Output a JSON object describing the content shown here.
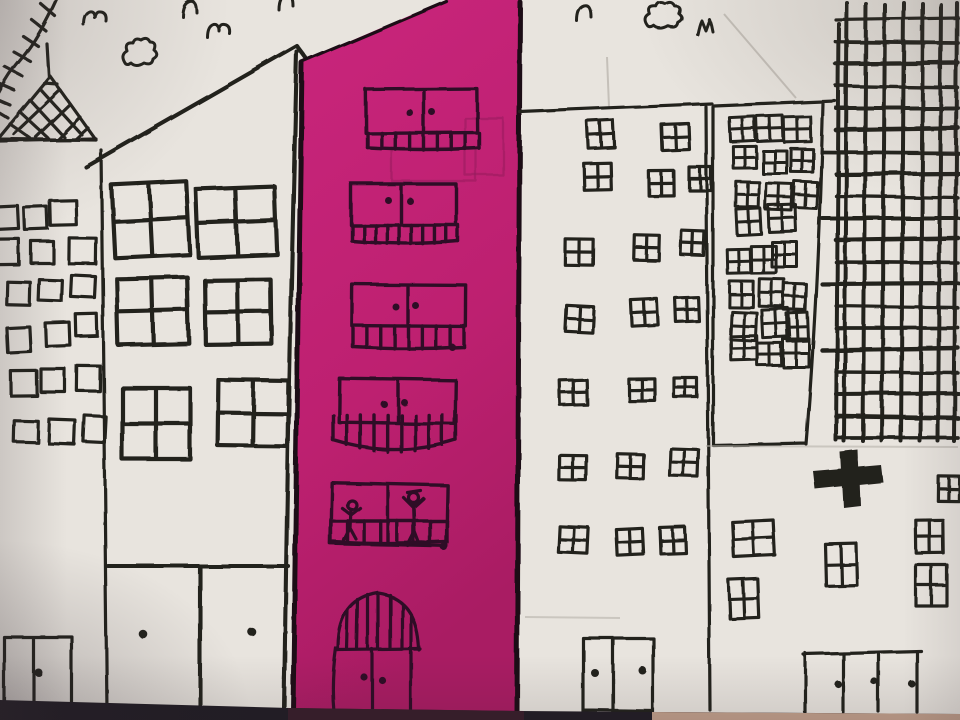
{
  "scene": {
    "description": "Child's felt-tip marker drawing of a city street on cream paper: a tower with a lattice spire, a peaked-roof house, a tall magenta tower with balconies and two stick figures, two white towers full of four-pane windows, a dense grid skyscraper, birds and scribbled clouds in the sky; the paper sits on a dark table edge.",
    "medium": "black marker on paper, magenta painted tower, photographed",
    "colors": {
      "paper": "#e8e4de",
      "ink": "#24201f",
      "ink_plum": "#2e1026",
      "magenta": "#c42478",
      "magenta_deep": "#a81c62",
      "pencil": "#b3aea6",
      "table_dark": "#211d25",
      "table_plum": "#3c1f2d",
      "table_tan": "#c2a08c"
    }
  },
  "sky": {
    "birds": [
      {
        "type": "m",
        "x": 84,
        "y": 10
      },
      {
        "type": "n",
        "x": 182,
        "y": 0
      },
      {
        "type": "m",
        "x": 207,
        "y": 22
      },
      {
        "type": "n",
        "x": 279,
        "y": -6
      },
      {
        "type": "n",
        "x": 577,
        "y": 5
      },
      {
        "type": "M",
        "x": 697,
        "y": 19
      }
    ],
    "clouds": [
      {
        "x": 121,
        "y": 37,
        "w": 37,
        "h": 33
      },
      {
        "x": 644,
        "y": 1,
        "w": 39,
        "h": 32
      }
    ],
    "creases": [
      [
        607,
        57,
        609,
        107
      ],
      [
        724,
        14,
        796,
        98
      ]
    ]
  },
  "buildings": {
    "left_tower": {
      "label": "tower with lattice spire",
      "window_type": "square",
      "windows": [
        [
          -6,
          206,
          24,
          23
        ],
        [
          24,
          207,
          23,
          22
        ],
        [
          50,
          200,
          26,
          25
        ],
        [
          -5,
          239,
          24,
          26
        ],
        [
          31,
          241,
          22,
          22
        ],
        [
          69,
          238,
          27,
          26
        ],
        [
          7,
          282,
          23,
          23
        ],
        [
          39,
          280,
          23,
          21
        ],
        [
          71,
          276,
          24,
          21
        ],
        [
          7,
          327,
          23,
          25
        ],
        [
          46,
          323,
          24,
          23
        ],
        [
          76,
          314,
          21,
          22
        ],
        [
          11,
          371,
          26,
          25
        ],
        [
          41,
          369,
          24,
          23
        ],
        [
          77,
          366,
          23,
          25
        ],
        [
          14,
          421,
          24,
          21
        ],
        [
          49,
          420,
          26,
          24
        ],
        [
          84,
          416,
          21,
          26
        ]
      ],
      "door": {
        "x": 4,
        "y": 637,
        "w": 68,
        "h": 70,
        "divider_x": 33,
        "dots": [
          [
            38,
            672
          ]
        ]
      }
    },
    "gable_house": {
      "label": "house with peaked roof",
      "window_type": "four-pane-large",
      "windows": [
        [
          113,
          183,
          75,
          73
        ],
        [
          197,
          188,
          79,
          68
        ],
        [
          117,
          278,
          71,
          66
        ],
        [
          205,
          280,
          66,
          64
        ],
        [
          122,
          388,
          68,
          71
        ],
        [
          218,
          380,
          70,
          66
        ]
      ],
      "doors": {
        "sill_y": 566,
        "x1": 108,
        "x2": 288,
        "divider_x": 200,
        "dots": [
          [
            143,
            634
          ],
          [
            252,
            632
          ]
        ]
      }
    },
    "magenta_tower": {
      "label": "magenta balcony tower",
      "figures_on_balcony": 2,
      "pencil_ghosts": [
        [
          392,
          148,
          84,
          33
        ],
        [
          465,
          118,
          38,
          57
        ]
      ],
      "floors": [
        {
          "win": [
            366,
            89,
            111,
            44
          ],
          "div": 424,
          "dots": [
            [
              410,
              113
            ],
            [
              432,
              112
            ]
          ],
          "rail": {
            "x1": 368,
            "x2": 479,
            "ytop": 133,
            "ybot": 150,
            "bars": 8,
            "curve": 2
          }
        },
        {
          "win": [
            351,
            184,
            105,
            41
          ],
          "div": 401,
          "dots": [
            [
              388,
              200
            ],
            [
              410,
              201
            ]
          ],
          "rail": {
            "x1": 352,
            "x2": 458,
            "ytop": 225,
            "ybot": 244,
            "bars": 9,
            "curve": 3
          }
        },
        {
          "win": [
            352,
            285,
            114,
            41
          ],
          "div": 408,
          "dots": [
            [
              396,
              307
            ],
            [
              416,
              306
            ],
            [
              452,
              347
            ]
          ],
          "rail": {
            "x1": 353,
            "x2": 464,
            "ytop": 326,
            "ybot": 349,
            "bars": 8,
            "curve": 2
          }
        },
        {
          "win": [
            339,
            379,
            116,
            44
          ],
          "div": 398,
          "dots": [
            [
              384,
              404
            ],
            [
              404,
              402
            ]
          ],
          "rail": {
            "x1": 333,
            "x2": 456,
            "ytop": 415,
            "ybot": 452,
            "bars": 9,
            "curve": 12
          }
        },
        {
          "win": [
            331,
            484,
            116,
            61
          ],
          "div": 388,
          "dots": [
            [
              444,
              547
            ]
          ],
          "midrail": 521,
          "rail": {
            "x1": 331,
            "x2": 447,
            "ytop": 521,
            "ybot": 544,
            "bars": 7,
            "curve": 2
          }
        }
      ],
      "door": {
        "dots": [
          [
            364,
            677
          ],
          [
            382,
            680
          ]
        ]
      }
    },
    "mid_tower": {
      "label": "white tower with scattered windows",
      "window_type": "four-pane-small",
      "windows": [
        [
          588,
          121,
          26,
          27
        ],
        [
          662,
          124,
          27,
          26
        ],
        [
          584,
          163,
          27,
          27
        ],
        [
          649,
          171,
          25,
          25
        ],
        [
          689,
          167,
          22,
          23
        ],
        [
          565,
          239,
          28,
          26
        ],
        [
          634,
          235,
          25,
          25
        ],
        [
          681,
          231,
          23,
          24
        ],
        [
          566,
          306,
          27,
          26
        ],
        [
          631,
          299,
          26,
          26
        ],
        [
          676,
          298,
          23,
          24
        ],
        [
          560,
          380,
          27,
          25
        ],
        [
          629,
          379,
          26,
          22
        ],
        [
          674,
          378,
          23,
          19
        ],
        [
          559,
          455,
          27,
          25
        ],
        [
          617,
          454,
          26,
          24
        ],
        [
          670,
          449,
          28,
          27
        ],
        [
          559,
          527,
          29,
          26
        ],
        [
          617,
          529,
          26,
          26
        ],
        [
          660,
          527,
          25,
          26
        ]
      ],
      "door": {
        "x": 583,
        "y": 638,
        "w": 70,
        "h": 74,
        "divider_x": 613,
        "dots": [
          [
            595,
            673
          ],
          [
            642,
            670
          ]
        ]
      },
      "pencil_lines": [
        [
          525,
          617,
          620,
          618
        ]
      ]
    },
    "dense_tower": {
      "label": "narrow tower packed with windows",
      "window_type": "four-pane-small",
      "windows": [
        [
          730,
          117,
          25,
          24
        ],
        [
          757,
          116,
          26,
          25
        ],
        [
          784,
          117,
          27,
          25
        ],
        [
          733,
          146,
          23,
          22
        ],
        [
          763,
          151,
          24,
          23
        ],
        [
          791,
          149,
          22,
          23
        ],
        [
          736,
          182,
          23,
          25
        ],
        [
          766,
          184,
          26,
          26
        ],
        [
          794,
          182,
          23,
          26
        ],
        [
          737,
          209,
          24,
          26
        ],
        [
          769,
          205,
          27,
          27
        ],
        [
          727,
          249,
          23,
          24
        ],
        [
          751,
          246,
          25,
          27
        ],
        [
          772,
          242,
          25,
          25
        ],
        [
          729,
          281,
          24,
          26
        ],
        [
          759,
          279,
          25,
          27
        ],
        [
          784,
          284,
          22,
          26
        ],
        [
          731,
          312,
          25,
          28
        ],
        [
          762,
          309,
          27,
          28
        ],
        [
          787,
          313,
          21,
          28
        ],
        [
          731,
          336,
          26,
          24
        ],
        [
          757,
          343,
          24,
          22
        ],
        [
          783,
          339,
          26,
          28
        ]
      ]
    },
    "grid_tower": {
      "label": "skyscraper drawn as dense grid",
      "cols": [
        847,
        866,
        885,
        904,
        923,
        941,
        957
      ],
      "rows": [
        20,
        42,
        64,
        86,
        108,
        130,
        152,
        174,
        196,
        218,
        240,
        262,
        284,
        306,
        328,
        350,
        372,
        394,
        416,
        438
      ],
      "tick_rows": [
        6,
        9,
        12,
        15
      ]
    },
    "corner_block": {
      "label": "lower-right block with cross",
      "window_type": "four-pane-small",
      "windows": [
        [
          733,
          521,
          41,
          35
        ],
        [
          729,
          579,
          29,
          39
        ],
        [
          826,
          544,
          31,
          42
        ],
        [
          916,
          520,
          27,
          33
        ],
        [
          916,
          565,
          31,
          41
        ],
        [
          938,
          476,
          21,
          25
        ]
      ],
      "door": {
        "top_y": 653,
        "x_lines": [
          805,
          843,
          879,
          917
        ],
        "x_end": 921,
        "dots": [
          [
            838,
            684
          ],
          [
            875,
            682
          ],
          [
            912,
            684
          ]
        ]
      },
      "pencil_lines": [
        [
          706,
          446,
          958,
          447
        ]
      ]
    }
  }
}
